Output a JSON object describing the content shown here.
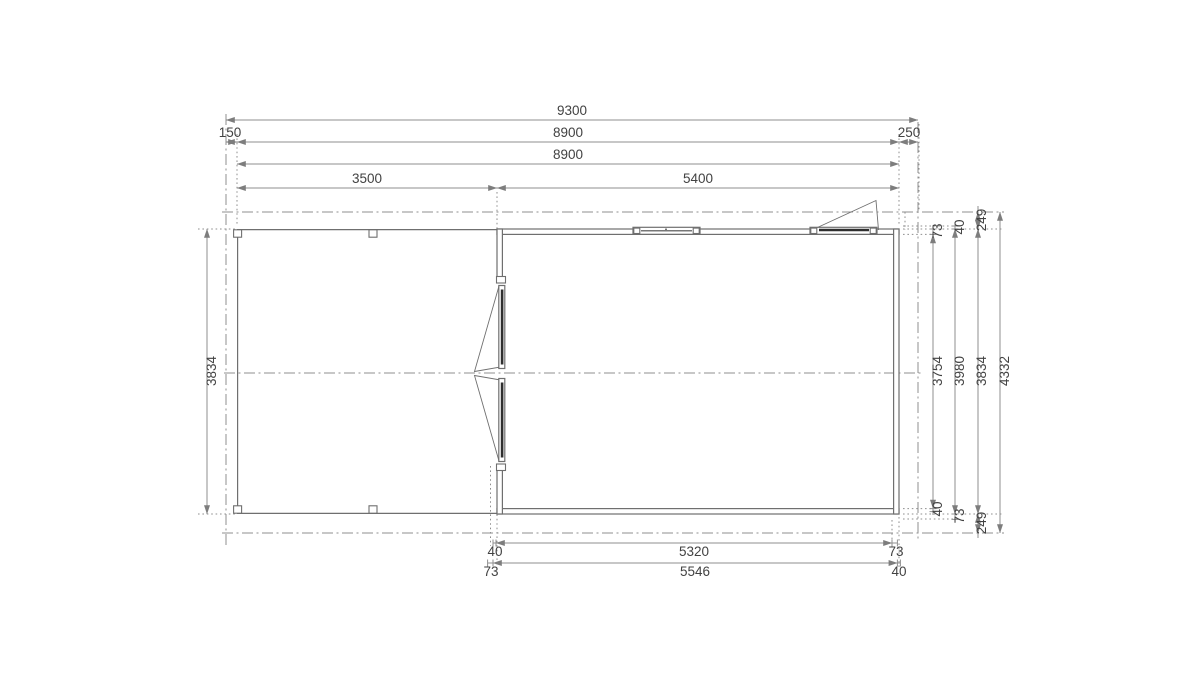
{
  "colors": {
    "background": "#ffffff",
    "line": "#8f8f8f",
    "wall": "#6f6f6f",
    "dark": "#2f2f2f",
    "text": "#424242"
  },
  "dims": {
    "top": {
      "overall": "9300",
      "left_overhang": "150",
      "outer_width": "8900",
      "right_overhang": "250",
      "frame_width": "8900",
      "carport_width": "3500",
      "cabin_width": "5400"
    },
    "left": {
      "side_depth": "3834"
    },
    "right": {
      "wall_top": "73",
      "interior_depth": "3754",
      "wall_bottom_inner": "40",
      "log_top": "40",
      "wall_outer_depth": "3980",
      "log_bottom": "73",
      "roof_overhang_top": "249",
      "side_depth": "3834",
      "roof_overhang_bottom": "249",
      "overall_depth": "4332"
    },
    "bottom": {
      "row1_left": "40",
      "row1_mid": "5320",
      "row1_right": "73",
      "row2_left": "73",
      "row2_mid": "5546",
      "row2_right": "40"
    }
  }
}
